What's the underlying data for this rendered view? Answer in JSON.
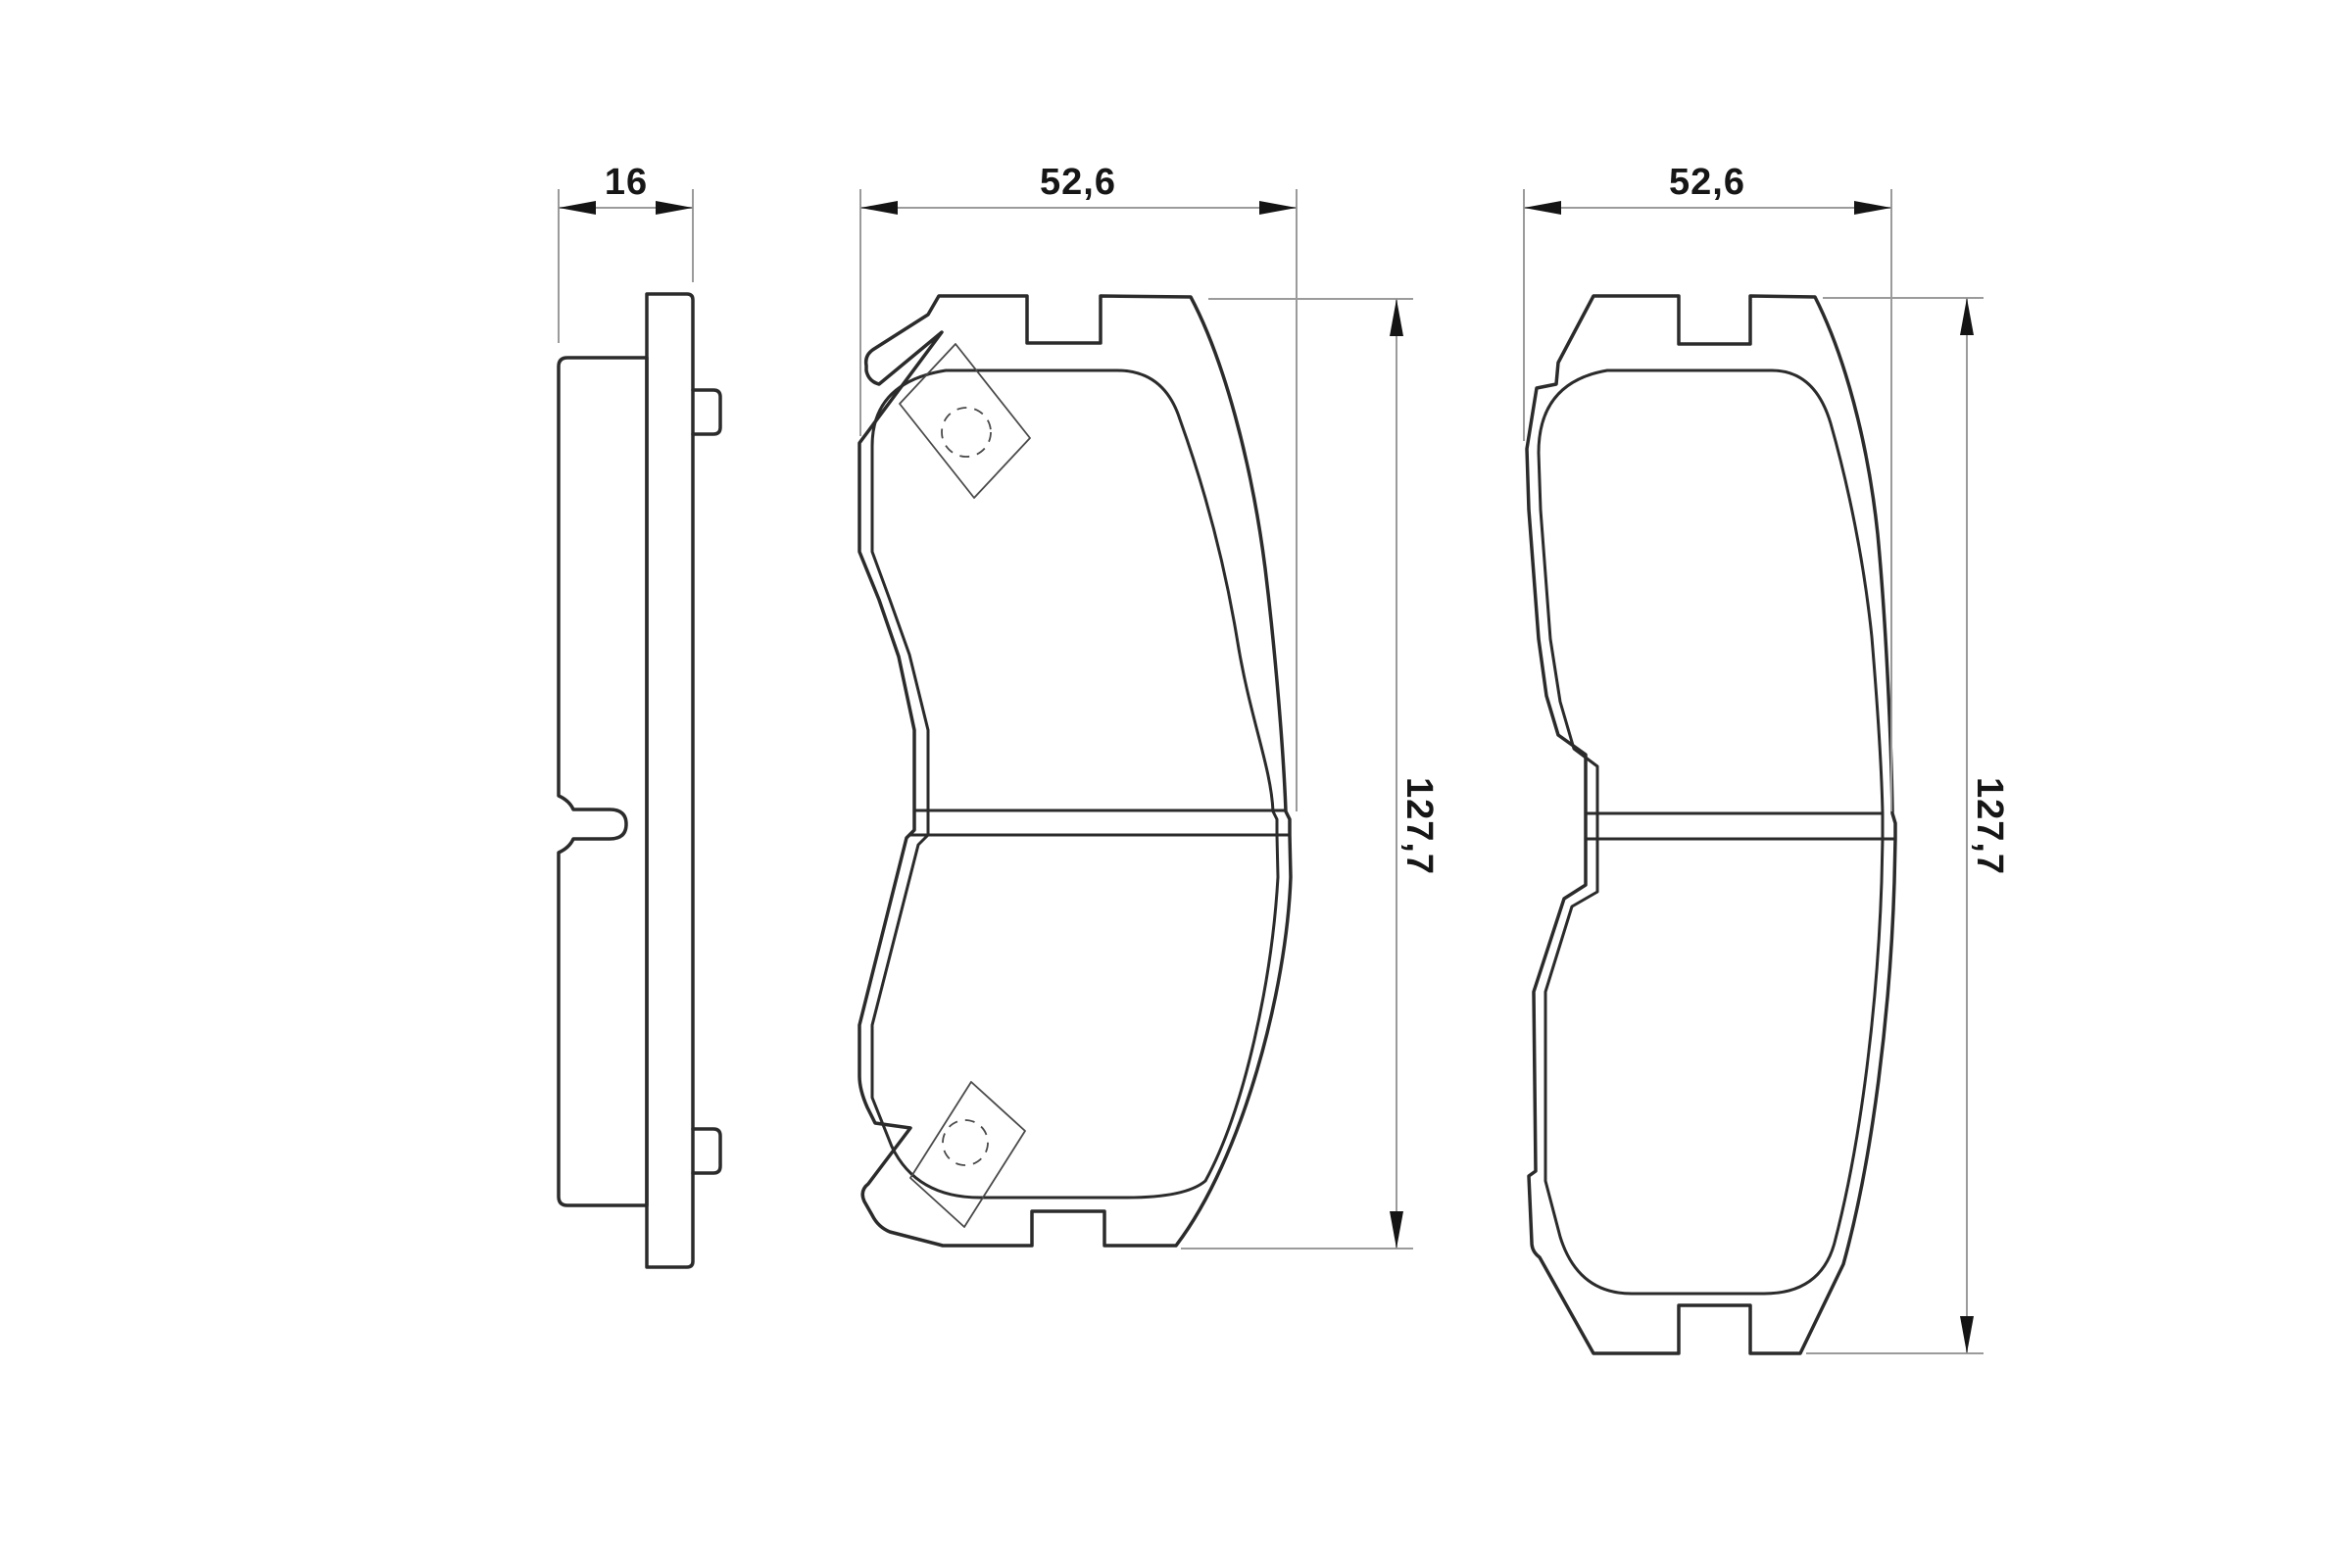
{
  "drawing": {
    "kind": "technical-drawing",
    "subject": "disc brake pad set, three orthographic views",
    "background_color": "#ffffff",
    "line_color": "#2b2b2b",
    "dimension_line_color": "#9b9b9b",
    "views": {
      "side_view": {
        "description": "edge view of pad showing backing plate, friction material, two mounting nubs and wear slot",
        "thickness_label": "16"
      },
      "front_view_left_pad": {
        "description": "face view of pad with angled ears, thin clip rectangles and dashed rivet holes, centre slot, top and bottom notches",
        "width_label": "52,6",
        "height_label": "127,7"
      },
      "front_view_right_pad": {
        "description": "face view of second pad without ears, centre slot, top and bottom notches",
        "width_label": "52,6",
        "height_label": "127,7"
      }
    }
  }
}
